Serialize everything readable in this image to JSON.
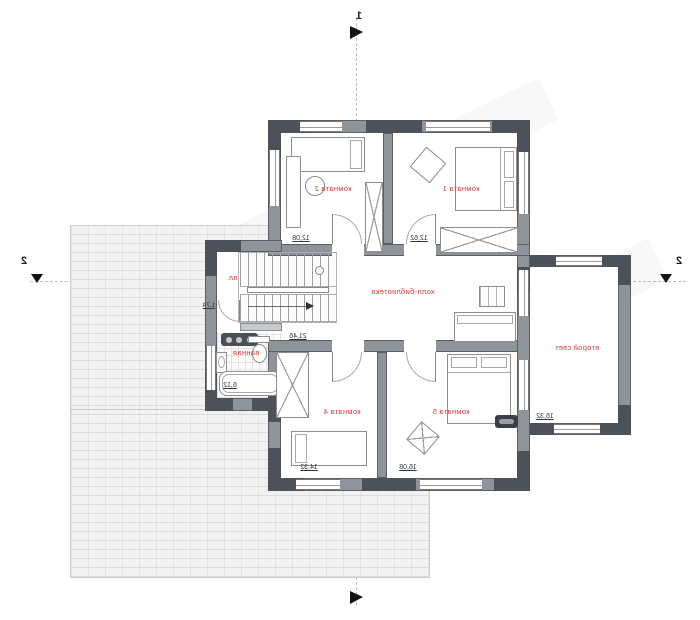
{
  "colors": {
    "wall": "#8f949b",
    "wall_dark": "#4c515a",
    "label_red": "#cc3b38",
    "hatch_line": "#dcdcdc"
  },
  "axis_markers": {
    "section_number": "1",
    "axis_number_left": "2",
    "axis_number_right": "2"
  },
  "rooms": [
    {
      "name": "комната 2",
      "area": "12,08"
    },
    {
      "name": "комната 1",
      "area": "12,62"
    },
    {
      "name": "холл-библиотека",
      "area": "21,46"
    },
    {
      "name": "ванная",
      "area": "6,12"
    },
    {
      "name": "комната 4",
      "area": "14,32"
    },
    {
      "name": "комната 5",
      "area": "16,08"
    },
    {
      "name": "второй свет",
      "area": "16,32"
    }
  ],
  "annotations": {
    "stair_landing": "пл.",
    "bath_dim": "1,74"
  }
}
